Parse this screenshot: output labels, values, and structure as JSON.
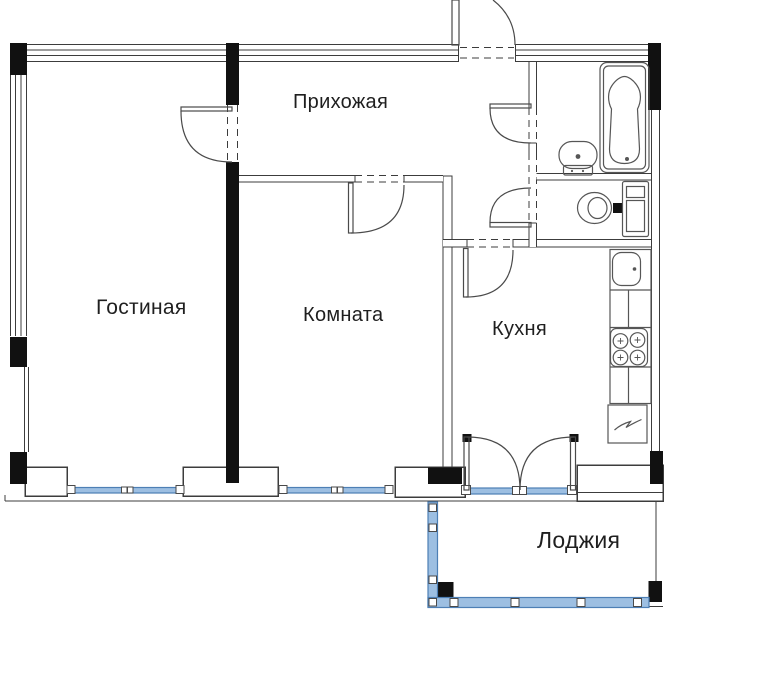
{
  "rooms": {
    "hallway": "Прихожая",
    "living_room": "Гостиная",
    "room": "Комната",
    "kitchen": "Кухня",
    "loggia": "Лоджия"
  },
  "fixtures": {
    "bathtub": "bathtub",
    "washbasin": "washbasin",
    "toilet": "toilet",
    "washing_machine": "washing-machine",
    "kitchen_sink": "kitchen-sink",
    "stove": "stove-4-burner",
    "refrigerator": "refrigerator"
  },
  "colors": {
    "background": "#ffffff",
    "wall_fill": "#111111",
    "line": "#3c3c3c",
    "fixture_line": "#565656",
    "window_fill": "#9dbfe2",
    "window_border": "#4d7fb5"
  }
}
